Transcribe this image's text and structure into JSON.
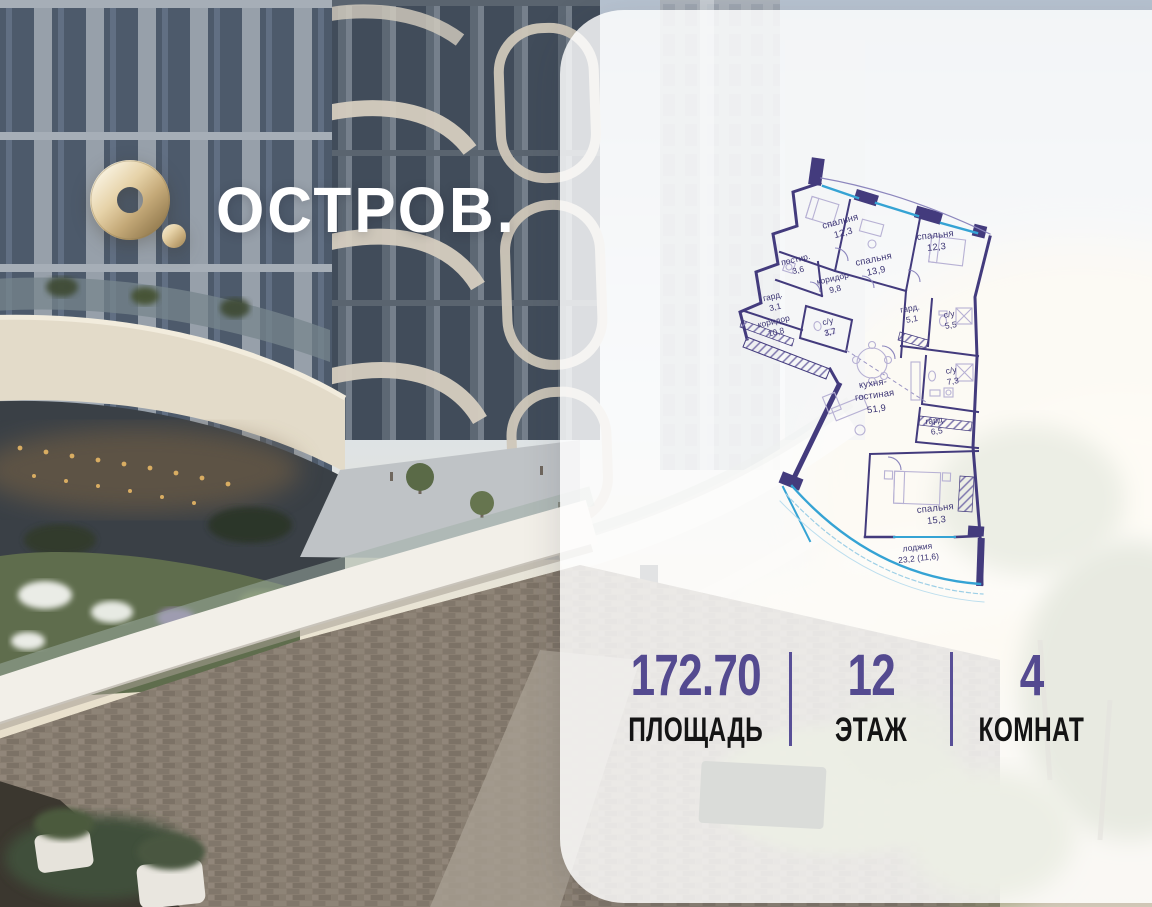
{
  "logo": {
    "brand": "ОСТРОВ.",
    "mark_icon": "gold-ring-logo"
  },
  "plan": {
    "rooms": [
      {
        "name": "спальня",
        "area": "12,3"
      },
      {
        "name": "спальня",
        "area": "13,9"
      },
      {
        "name": "спальня",
        "area": "12,3"
      },
      {
        "name": "постир.",
        "area": "3,6"
      },
      {
        "name": "коридор",
        "area": "9,8"
      },
      {
        "name": "гард.",
        "area": "3,1"
      },
      {
        "name": "коридор",
        "area": "10,8"
      },
      {
        "name": "с/у",
        "area": "3,7"
      },
      {
        "name": "гард.",
        "area": "5,1"
      },
      {
        "name": "с/у",
        "area": "5,5"
      },
      {
        "name": "с/у",
        "area": "7,3"
      },
      {
        "name": "кухня-",
        "name2": "гостиная",
        "area": "51,9"
      },
      {
        "name": "гард.",
        "area": "6,5"
      },
      {
        "name": "спальня",
        "area": "15,3"
      },
      {
        "name": "лоджия",
        "area": "23,2 (11,6)"
      }
    ]
  },
  "stats": {
    "items": [
      {
        "value": "172.70",
        "label": "ПЛОЩАДЬ"
      },
      {
        "value": "12",
        "label": "ЭТАЖ"
      },
      {
        "value": "4",
        "label": "КОМНАТ"
      }
    ]
  },
  "colors": {
    "accent_purple": "#564d99",
    "plan_wall": "#433b7d",
    "glazing_blue": "#35a3d4",
    "logo_gold": "#c9b184",
    "panel_white": "rgba(255,255,255,0.82)"
  }
}
